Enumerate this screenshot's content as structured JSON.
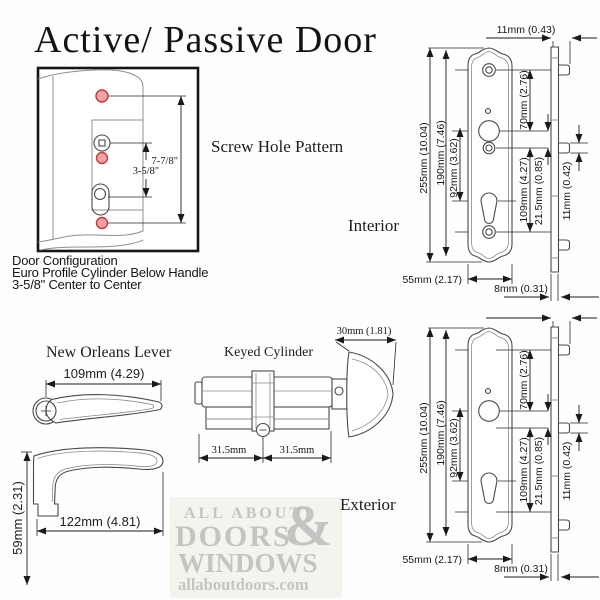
{
  "title": "Active/ Passive Door",
  "screw_pattern": {
    "heading": "Screw Hole Pattern",
    "dim_long": "7-7/8\"",
    "dim_short": "3-5/8\"",
    "caption": [
      "Door Configuration",
      "Euro Profile Cylinder Below Handle",
      "3-5/8\" Center to Center"
    ]
  },
  "lever": {
    "heading": "New Orleans Lever",
    "top_width": "109mm (4.29)",
    "side_width": "122mm (4.81)",
    "side_height": "59mm (2.31)"
  },
  "cylinder": {
    "heading": "Keyed Cylinder",
    "thumbturn_width": "30mm (1.81)",
    "half_left": "31.5mm",
    "half_right": "31.5mm"
  },
  "plate_dims": {
    "overall": "255mm (10.04)",
    "screw_spacing": "190mm (7.46)",
    "handle_to_cylinder": "92mm (3.62)",
    "screw_to_handle": "70mm (2.76)",
    "handle_span": "109mm (4.27)",
    "handle_offset": "21.5mm (0.85)",
    "boss_depth": "11mm (0.42)",
    "backset_depth": "11mm (0.43)",
    "width": "55mm (2.17)",
    "thickness": "8mm (0.31)"
  },
  "views": {
    "interior_label": "Interior",
    "exterior_label": "Exterior"
  },
  "watermark": {
    "line1": "ALL ABOUT",
    "amp": "&",
    "line2": "DOORS",
    "line3": "WINDOWS",
    "line4": "allaboutdoors.com"
  },
  "colors": {
    "screw_hole_fill": "#f2a2a2",
    "screw_hole_stroke": "#c4393c",
    "line": "#1a1a1a",
    "watermark_gray": "#c4c4c4"
  }
}
